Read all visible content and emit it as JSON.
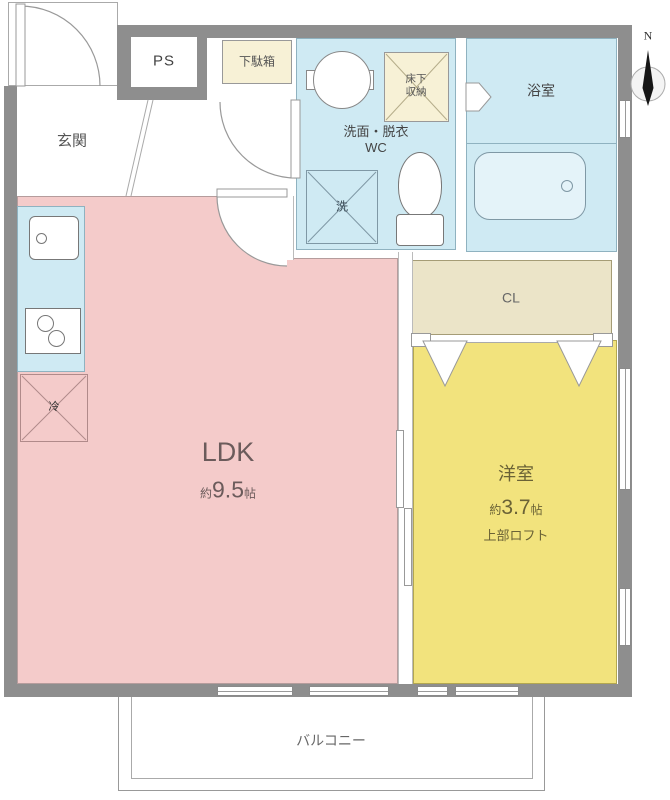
{
  "colors": {
    "wall": "#8e8e8e",
    "ldk": "#f4cbca",
    "western": "#f2e37d",
    "wet": "#cfeaf3",
    "closet": "#ebe4c8",
    "storage": "#f7f1d6"
  },
  "compass": {
    "label": "N"
  },
  "rooms": {
    "genkan": {
      "label": "玄関"
    },
    "ldk": {
      "name": "LDK",
      "size_prefix": "約",
      "size_value": "9.5",
      "size_unit": "帖"
    },
    "western": {
      "name": "洋室",
      "size_prefix": "約",
      "size_value": "3.7",
      "size_unit": "帖",
      "note": "上部ロフト"
    },
    "washroom": {
      "line1": "洗面・脱衣",
      "line2": "WC"
    },
    "bathroom": {
      "label": "浴室"
    },
    "closet": {
      "label": "CL"
    },
    "balcony": {
      "label": "バルコニー"
    }
  },
  "fixtures": {
    "pipe_space": "PS",
    "shoe_cabinet": "下駄箱",
    "underfloor_storage_line1": "床下",
    "underfloor_storage_line2": "収納",
    "washer": "洗",
    "refrigerator": "冷"
  }
}
